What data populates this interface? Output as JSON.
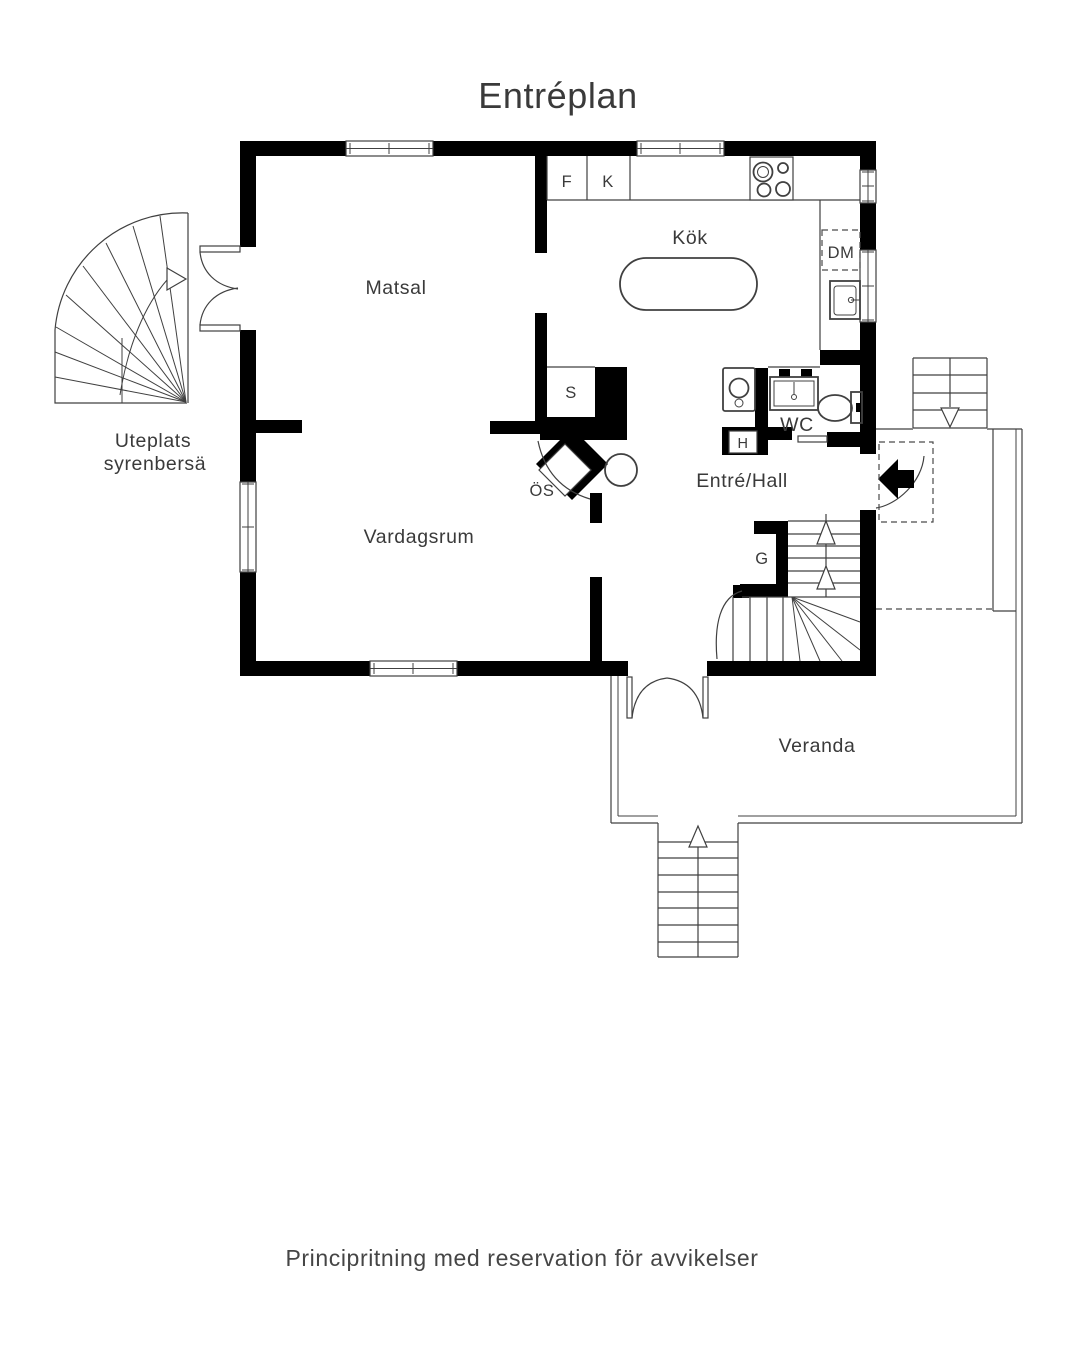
{
  "title": "Entréplan",
  "footer": "Principritning med reservation för avvikelser",
  "rooms": {
    "matsal": "Matsal",
    "kok": "Kök",
    "vardagsrum": "Vardagsrum",
    "entre_hall": "Entré/Hall",
    "wc": "WC",
    "veranda": "Veranda"
  },
  "labels": {
    "f": "F",
    "k": "K",
    "s": "S",
    "os": "ÖS",
    "g": "G",
    "h": "H",
    "dm": "DM"
  },
  "outdoor": {
    "uteplats_line1": "Uteplats",
    "uteplats_line2": "syrenbersä"
  },
  "colors": {
    "wall": "#000000",
    "line": "#404040",
    "text": "#3a3a3a",
    "background": "#ffffff"
  }
}
